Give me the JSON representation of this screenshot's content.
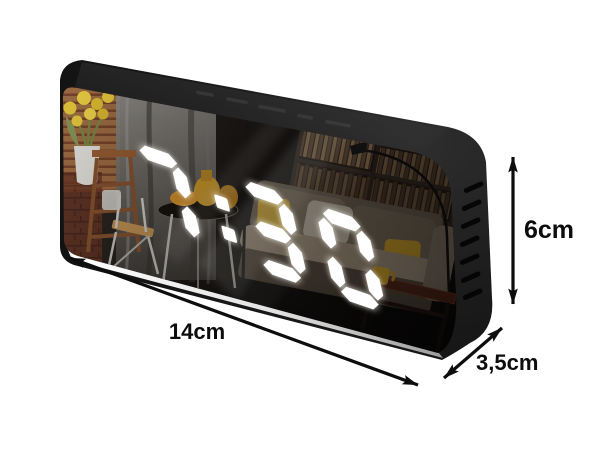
{
  "background_color": "#ffffff",
  "clock": {
    "time": "7:30",
    "led_color": "#ffffff",
    "body_color": "#1a1a1a",
    "display_style": "7-segment",
    "vent_slot_count": 7
  },
  "annotations": {
    "color": "#0d0d0d",
    "width": {
      "label": "14cm"
    },
    "height": {
      "label": "6cm"
    },
    "depth": {
      "label": "3,5cm"
    }
  }
}
